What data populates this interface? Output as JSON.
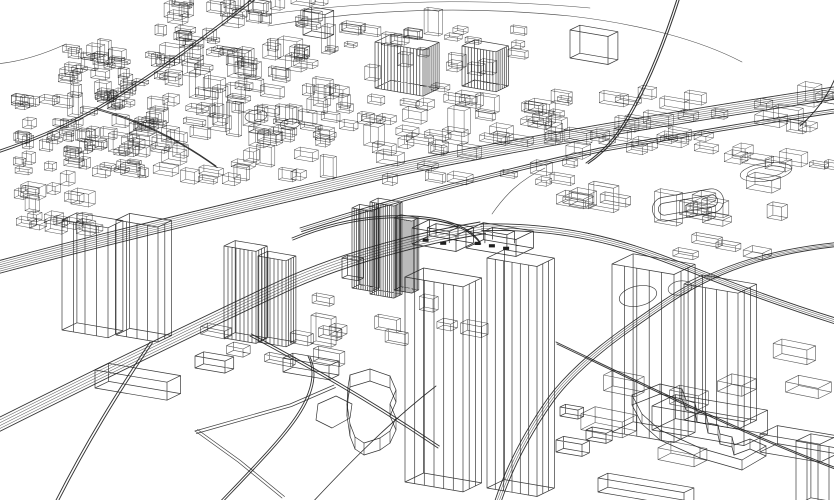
{
  "meta": {
    "description": "3-D wireframe city sketch, black vector line art on white",
    "ink": "#1f1f1f",
    "background": "#ffffff"
  },
  "canvas": {
    "width": 834,
    "height": 500
  },
  "scene": {
    "defaults": {
      "u": [
        1,
        0.17
      ],
      "v": [
        0.62,
        -0.3
      ]
    },
    "curves": [
      {
        "d": "M 268 26 C 370 8 470 6 570 16 C 640 24 700 40 742 62",
        "sw": 0.6
      },
      {
        "d": "M 268 14 C 380 0 480 -2 590 8",
        "sw": 0.5
      },
      {
        "d": "M 492 214 C 505 195 520 180 545 168",
        "sw": 0.6
      },
      {
        "d": "M 66 44 C 40 56 18 62 -4 64",
        "sw": 0.6
      }
    ],
    "roads": [
      {
        "name": "rail-main",
        "d": "M -6 262 C 120 228 260 196 380 167 C 500 140 670 112 840 86",
        "lanes": 7,
        "off": [
          0.5,
          2.0
        ],
        "sw": 0.55
      },
      {
        "name": "road-upper-parallel",
        "d": "M 300 228 C 400 196 500 170 600 148 C 680 134 760 120 842 108",
        "lanes": 3,
        "off": [
          0.8,
          1.8
        ],
        "sw": 0.55
      },
      {
        "name": "highway-left-sweep",
        "d": "M -6 420 C 90 372 200 318 290 276 C 350 250 420 232 480 222",
        "lanes": 6,
        "off": [
          1.1,
          2.3
        ],
        "sw": 0.55
      },
      {
        "name": "highway-right",
        "d": "M 480 224 C 560 222 620 238 680 262 C 740 286 790 304 842 320",
        "lanes": 4,
        "off": [
          0.6,
          2.2
        ],
        "sw": 0.55
      },
      {
        "name": "s-curve-east",
        "d": "M 842 242 C 780 248 720 262 664 300 C 620 330 576 360 548 398 C 524 432 504 470 492 510",
        "lanes": 4,
        "off": [
          1.8,
          1.1
        ],
        "sw": 0.55
      },
      {
        "name": "ramp-top-right",
        "d": "M 678 -4 C 664 40 648 80 630 112 C 616 138 602 152 586 163",
        "lanes": 2,
        "off": [
          2.2,
          0.6
        ],
        "sw": 0.7
      },
      {
        "name": "corner-top-right",
        "d": "M 800 126 C 816 112 828 96 836 76",
        "lanes": 1,
        "off": [
          2,
          1
        ],
        "sw": 0.6
      },
      {
        "name": "diag-top-left",
        "d": "M 256 -4 C 200 40 150 76 96 108 C 60 128 30 140 -6 152",
        "lanes": 2,
        "off": [
          1.4,
          1.8
        ],
        "sw": 0.6
      },
      {
        "name": "road-bottom-left",
        "d": "M 150 342 C 118 390 84 444 52 508",
        "lanes": 2,
        "off": [
          2.4,
          0.9
        ],
        "sw": 0.6
      },
      {
        "name": "center-ring",
        "d": "M 292 238 C 330 222 370 214 412 216 C 450 218 470 228 480 242",
        "lanes": 2,
        "off": [
          0.8,
          2.0
        ],
        "sw": 0.55
      },
      {
        "name": "diag-bottom-right",
        "d": "M 556 342 C 640 382 740 432 842 470",
        "lanes": 2,
        "off": [
          1.0,
          2.0
        ],
        "sw": 0.6
      },
      {
        "name": "cross-plaza-a",
        "d": "M 250 336 C 310 368 370 402 438 448",
        "lanes": 2,
        "off": [
          1.3,
          -2.0
        ],
        "sw": 0.55
      },
      {
        "name": "cross-plaza-b",
        "d": "M 310 505 C 350 462 392 420 436 386",
        "lanes": 1,
        "off": [
          1,
          1
        ],
        "sw": 0.5
      },
      {
        "name": "plateau-loop",
        "d": "M 214 508 C 250 470 280 440 296 416 C 312 392 316 372 308 356",
        "lanes": 2,
        "off": [
          2.0,
          1.0
        ],
        "sw": 0.55
      },
      {
        "name": "inner-top-left",
        "d": "M 96 108 C 140 120 180 140 216 166",
        "lanes": 2,
        "off": [
          1.2,
          1.6
        ],
        "sw": 0.5
      }
    ],
    "polylines": [
      {
        "name": "parcel-edge-a",
        "pts": [
          [
            195,
            431
          ],
          [
            238,
            462
          ],
          [
            282,
            498
          ]
        ],
        "closed": false,
        "dbl": [
          2.5,
          -1.5
        ],
        "sw": 0.7
      },
      {
        "name": "parcel-edge-b",
        "pts": [
          [
            195,
            431
          ],
          [
            290,
            404
          ],
          [
            334,
            385
          ]
        ],
        "closed": false,
        "dbl": [
          1.5,
          2.5
        ],
        "sw": 0.7
      }
    ],
    "prisms": [
      {
        "name": "terraced-plateau",
        "h": 12,
        "sw": 0.7,
        "pts": [
          [
            350,
            387
          ],
          [
            370,
            381
          ],
          [
            390,
            388
          ],
          [
            396,
            402
          ],
          [
            390,
            416
          ],
          [
            396,
            430
          ],
          [
            390,
            443
          ],
          [
            380,
            450
          ],
          [
            364,
            455
          ],
          [
            355,
            449
          ],
          [
            350,
            436
          ],
          [
            347,
            416
          ],
          [
            348,
            399
          ]
        ]
      },
      {
        "name": "jagged-l-building",
        "h": 10,
        "sw": 0.7,
        "pts": [
          [
            632,
            405
          ],
          [
            660,
            394
          ],
          [
            682,
            399
          ],
          [
            686,
            410
          ],
          [
            695,
            413
          ],
          [
            697,
            422
          ],
          [
            706,
            424
          ],
          [
            708,
            433
          ],
          [
            718,
            435
          ],
          [
            720,
            444
          ],
          [
            732,
            447
          ],
          [
            734,
            455
          ],
          [
            750,
            449
          ],
          [
            766,
            456
          ],
          [
            742,
            470
          ],
          [
            700,
            458
          ],
          [
            660,
            440
          ],
          [
            642,
            424
          ]
        ]
      },
      {
        "name": "pond-south",
        "h": 0,
        "sw": 0.7,
        "pts": [
          [
            318,
            404
          ],
          [
            336,
            396
          ],
          [
            352,
            404
          ],
          [
            350,
            418
          ],
          [
            332,
            428
          ],
          [
            316,
            420
          ]
        ]
      }
    ],
    "ellipses": [
      {
        "name": "oval-park-a",
        "cx": 256,
        "cy": 116,
        "rx": 11,
        "ry": 6,
        "rot": -8,
        "sw": 0.6
      },
      {
        "name": "oval-park-b",
        "cx": 290,
        "cy": 124,
        "rx": 10,
        "ry": 5,
        "rot": -8,
        "sw": 0.6
      },
      {
        "name": "pond-east",
        "cx": 638,
        "cy": 296,
        "rx": 19,
        "ry": 10,
        "rot": -12,
        "sw": 0.7
      },
      {
        "name": "circle-plaza-east",
        "cx": 680,
        "cy": 288,
        "rx": 12,
        "ry": 7,
        "rot": -10,
        "sw": 0.6
      },
      {
        "name": "oval-top-right",
        "cx": 766,
        "cy": 172,
        "rx": 26,
        "ry": 9,
        "rot": -8,
        "sw": 0.6
      },
      {
        "name": "oval-top-right-inner",
        "cx": 766,
        "cy": 172,
        "rx": 19,
        "ry": 5.5,
        "rot": -8,
        "sw": 0.5
      }
    ],
    "stadiums": [
      {
        "name": "stadium-track",
        "cx": 688,
        "cy": 205,
        "w": 72,
        "h": 24,
        "rot": -10,
        "inner": 6,
        "sw": 0.7
      }
    ],
    "clusters": [
      {
        "name": "blocks-far-left-low",
        "seed": 11,
        "n": 60,
        "x": [
          2,
          150
        ],
        "y": [
          98,
          178
        ],
        "w": [
          7,
          18
        ],
        "d": [
          4,
          10
        ],
        "h": [
          3,
          12
        ],
        "u": [
          1,
          0.15
        ],
        "v": [
          0.55,
          -0.26
        ],
        "sw": 0.5
      },
      {
        "name": "blocks-far-left-top",
        "seed": 12,
        "n": 30,
        "x": [
          55,
          165
        ],
        "y": [
          52,
          102
        ],
        "w": [
          7,
          17
        ],
        "d": [
          4,
          10
        ],
        "h": [
          3,
          12
        ],
        "u": [
          1,
          0.15
        ],
        "v": [
          0.55,
          -0.26
        ],
        "sw": 0.5
      },
      {
        "name": "blocks-top-edge",
        "seed": 13,
        "n": 40,
        "x": [
          150,
          345
        ],
        "y": [
          2,
          60
        ],
        "w": [
          8,
          20
        ],
        "d": [
          4,
          11
        ],
        "h": [
          3,
          14
        ],
        "u": [
          1,
          0.15
        ],
        "v": [
          0.55,
          -0.26
        ],
        "sw": 0.5
      },
      {
        "name": "blocks-topcenter",
        "seed": 14,
        "n": 55,
        "x": [
          150,
          340
        ],
        "y": [
          58,
          130
        ],
        "w": [
          8,
          20
        ],
        "d": [
          4,
          11
        ],
        "h": [
          4,
          16
        ],
        "u": [
          1,
          0.16
        ],
        "v": [
          0.58,
          -0.28
        ],
        "sw": 0.5
      },
      {
        "name": "blocks-midband-left",
        "seed": 15,
        "n": 40,
        "x": [
          95,
          330
        ],
        "y": [
          128,
          185
        ],
        "w": [
          9,
          20
        ],
        "d": [
          5,
          12
        ],
        "h": [
          4,
          14
        ],
        "u": [
          1,
          0.17
        ],
        "v": [
          0.6,
          -0.29
        ],
        "sw": 0.5
      },
      {
        "name": "blocks-center-band",
        "seed": 16,
        "n": 48,
        "x": [
          335,
          558
        ],
        "y": [
          98,
          186
        ],
        "w": [
          9,
          22
        ],
        "d": [
          5,
          12
        ],
        "h": [
          4,
          12
        ],
        "u": [
          1,
          0.17
        ],
        "v": [
          0.6,
          -0.29
        ],
        "sw": 0.5
      },
      {
        "name": "blocks-around-hatch",
        "seed": 17,
        "n": 20,
        "x": [
          350,
          520
        ],
        "y": [
          30,
          95
        ],
        "w": [
          8,
          18
        ],
        "d": [
          4,
          10
        ],
        "h": [
          4,
          14
        ],
        "u": [
          1,
          0.15
        ],
        "v": [
          0.56,
          -0.27
        ],
        "sw": 0.5
      },
      {
        "name": "blocks-topright-strip",
        "seed": 18,
        "n": 38,
        "x": [
          560,
          832
        ],
        "y": [
          92,
          170
        ],
        "w": [
          10,
          26
        ],
        "d": [
          6,
          14
        ],
        "h": [
          4,
          12
        ],
        "u": [
          1,
          0.17
        ],
        "v": [
          0.6,
          -0.29
        ],
        "sw": 0.5
      },
      {
        "name": "blocks-right-mid",
        "seed": 19,
        "n": 18,
        "x": [
          556,
          780
        ],
        "y": [
          178,
          262
        ],
        "w": [
          12,
          28
        ],
        "d": [
          7,
          15
        ],
        "h": [
          5,
          14
        ],
        "u": [
          1,
          0.18
        ],
        "v": [
          0.64,
          -0.31
        ],
        "sw": 0.55
      },
      {
        "name": "blocks-left-mid",
        "seed": 20,
        "n": 18,
        "x": [
          2,
          85
        ],
        "y": [
          180,
          235
        ],
        "w": [
          8,
          20
        ],
        "d": [
          5,
          12
        ],
        "h": [
          4,
          14
        ],
        "u": [
          1,
          0.18
        ],
        "v": [
          0.62,
          -0.3
        ],
        "sw": 0.5
      },
      {
        "name": "slabs-bottom-right",
        "seed": 21,
        "n": 7,
        "x": [
          555,
          820
        ],
        "y": [
          352,
          468
        ],
        "w": [
          22,
          46
        ],
        "d": [
          10,
          22
        ],
        "h": [
          8,
          20
        ],
        "u": [
          1,
          0.2
        ],
        "v": [
          0.68,
          -0.34
        ],
        "sw": 0.6
      },
      {
        "name": "boxes-bottom-center",
        "seed": 22,
        "n": 6,
        "x": [
          200,
          345
        ],
        "y": [
          332,
          376
        ],
        "w": [
          14,
          30
        ],
        "d": [
          7,
          14
        ],
        "h": [
          6,
          16
        ],
        "u": [
          1,
          0.2
        ],
        "v": [
          0.66,
          -0.33
        ],
        "sw": 0.6
      },
      {
        "name": "boxes-plaza",
        "seed": 23,
        "n": 8,
        "x": [
          296,
          470
        ],
        "y": [
          300,
          344
        ],
        "w": [
          10,
          22
        ],
        "d": [
          5,
          11
        ],
        "h": [
          5,
          14
        ],
        "u": [
          1,
          0.19
        ],
        "v": [
          0.64,
          -0.32
        ],
        "sw": 0.55
      }
    ],
    "buildings": [
      {
        "name": "box-top-center",
        "x": 303,
        "y": 35,
        "w": 22,
        "d": 14,
        "h": 24,
        "stripes": 0
      },
      {
        "name": "hatched-slab-a",
        "x": 375,
        "y": 88,
        "w": 48,
        "d": 26,
        "h": 46,
        "stripes": 14
      },
      {
        "name": "hatched-slab-b",
        "x": 462,
        "y": 86,
        "w": 34,
        "d": 20,
        "h": 40,
        "stripes": 10
      },
      {
        "name": "tall-box-top-right",
        "x": 570,
        "y": 58,
        "w": 38,
        "d": 16,
        "h": 28,
        "stripes": 0
      },
      {
        "name": "tower-left-a",
        "x": 62,
        "y": 330,
        "w": 46,
        "d": 24,
        "h": 110,
        "stripes": 3
      },
      {
        "name": "tower-left-b",
        "x": 116,
        "y": 335,
        "w": 42,
        "d": 22,
        "h": 115,
        "stripes": 3
      },
      {
        "name": "tower-mid-a",
        "x": 224,
        "y": 338,
        "w": 32,
        "d": 18,
        "h": 92,
        "stripes": 7
      },
      {
        "name": "tower-mid-b",
        "x": 258,
        "y": 342,
        "w": 28,
        "d": 16,
        "h": 86,
        "stripes": 6
      },
      {
        "name": "fluted-tower-a",
        "x": 352,
        "y": 288,
        "w": 20,
        "d": 12,
        "h": 80,
        "stripes": 8
      },
      {
        "name": "fluted-tower-b",
        "x": 370,
        "y": 294,
        "w": 24,
        "d": 13,
        "h": 92,
        "stripes": 10
      },
      {
        "name": "fluted-tower-c",
        "x": 394,
        "y": 290,
        "w": 18,
        "d": 11,
        "h": 72,
        "stripes": 8
      },
      {
        "name": "small-box-fluted",
        "x": 342,
        "y": 278,
        "w": 16,
        "d": 9,
        "h": 20,
        "stripes": 0
      },
      {
        "name": "glass-tower-a",
        "x": 405,
        "y": 482,
        "w": 58,
        "d": 30,
        "h": 205,
        "stripes": 5
      },
      {
        "name": "glass-tower-b",
        "x": 487,
        "y": 488,
        "w": 50,
        "d": 28,
        "h": 230,
        "stripes": 5
      },
      {
        "name": "glass-tower-east-a",
        "x": 612,
        "y": 432,
        "w": 62,
        "d": 34,
        "h": 168,
        "stripes": 4
      },
      {
        "name": "glass-tower-east-b",
        "x": 684,
        "y": 420,
        "w": 54,
        "d": 30,
        "h": 136,
        "stripes": 4
      },
      {
        "name": "tower-far-right-bottom",
        "x": 796,
        "y": 505,
        "w": 44,
        "d": 24,
        "h": 64,
        "stripes": 3
      },
      {
        "name": "warehouse-bottom-right",
        "x": 652,
        "y": 430,
        "w": 92,
        "d": 38,
        "h": 24,
        "stripes": 0
      },
      {
        "name": "slab-bottom-right-east",
        "x": 760,
        "y": 452,
        "w": 60,
        "d": 28,
        "h": 18,
        "stripes": 0
      },
      {
        "name": "long-box-bottom-left",
        "x": 95,
        "y": 388,
        "w": 72,
        "d": 22,
        "h": 18,
        "stripes": 0
      },
      {
        "name": "long-box-bottom-south",
        "x": 598,
        "y": 492,
        "w": 86,
        "d": 16,
        "h": 14,
        "stripes": 0
      },
      {
        "name": "box-bottom-pair-a",
        "x": 195,
        "y": 368,
        "w": 30,
        "d": 14,
        "h": 12,
        "stripes": 0
      },
      {
        "name": "box-bottom-small-a",
        "x": 556,
        "y": 452,
        "w": 26,
        "d": 12,
        "h": 12,
        "stripes": 0
      },
      {
        "name": "box-bottom-small-b",
        "x": 586,
        "y": 440,
        "w": 20,
        "d": 10,
        "h": 10,
        "stripes": 0
      },
      {
        "name": "box-bottom-small-c",
        "x": 560,
        "y": 416,
        "w": 18,
        "d": 9,
        "h": 9,
        "stripes": 0
      },
      {
        "name": "slab-center-south",
        "x": 283,
        "y": 372,
        "w": 46,
        "d": 16,
        "h": 14,
        "stripes": 0
      }
    ],
    "rings": [
      {
        "name": "courtyard-building-a",
        "x": 412,
        "y": 244,
        "w": 44,
        "d": 28,
        "h": 16,
        "inset": 0.25,
        "windows": 2
      },
      {
        "name": "courtyard-building-b",
        "x": 466,
        "y": 248,
        "w": 50,
        "d": 28,
        "h": 17,
        "inset": 0.28,
        "windows": 3
      }
    ]
  }
}
